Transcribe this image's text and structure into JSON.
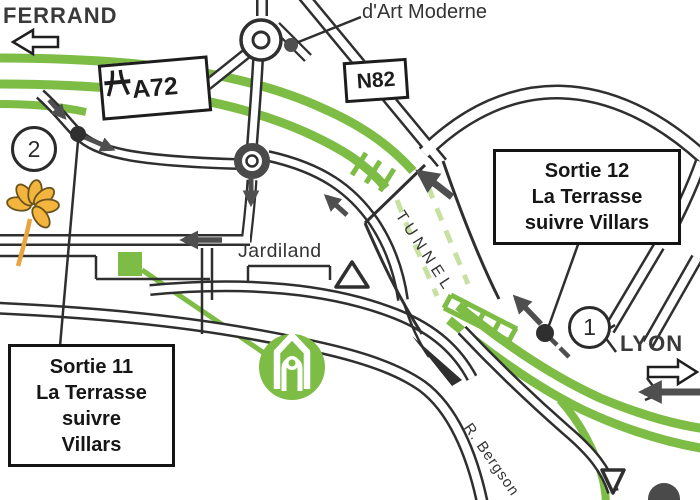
{
  "map": {
    "colors": {
      "motorway_green": "#7dbc45",
      "tunnel_dash": "#c8e0a2",
      "road_dark": "#2f2f2f",
      "arrow_gray": "#4f4f4f",
      "flower_yellow": "#f3b53e",
      "flower_stem": "#e8a43e",
      "text_dark": "#2e2e2e"
    },
    "labels": {
      "clermont_line1": "CLERMONT",
      "clermont_line2": "FERRAND",
      "art_moderne": "d'Art Moderne",
      "a72": "A72",
      "n82": "N82",
      "jardiland": "Jardiland",
      "tunnel": "TUNNEL",
      "lyon": "LYON",
      "street": "R. Bergson",
      "badge1": "1",
      "badge2": "2"
    },
    "callouts": {
      "sortie12": {
        "l1": "Sortie 12",
        "l2": "La Terrasse",
        "l3": "suivre Villars"
      },
      "sortie11": {
        "l1": "Sortie 11",
        "l2": "La Terrasse",
        "l3": "suivre",
        "l4": "Villars"
      }
    }
  }
}
